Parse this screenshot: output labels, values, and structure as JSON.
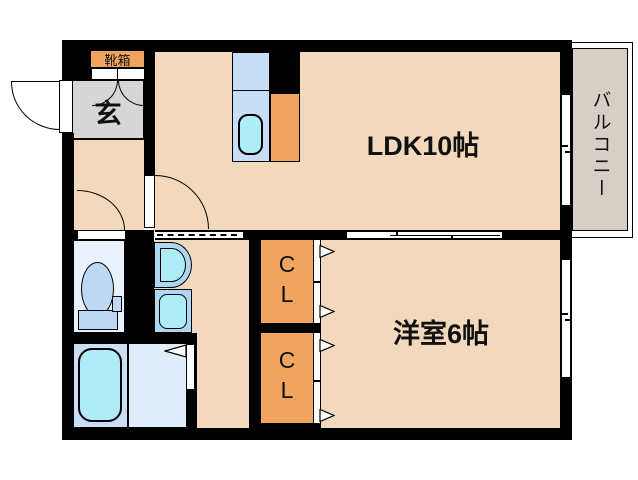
{
  "image_type": "apartment floor plan",
  "rooms": {
    "ldk": {
      "label": "LDK10帖"
    },
    "bedroom": {
      "label": "洋室6帖"
    },
    "balcony": {
      "label": "バルコニー"
    },
    "genkan": {
      "label": "玄"
    },
    "closet1": {
      "label": "C\nL"
    },
    "closet2": {
      "label": "C\nL"
    }
  },
  "fixtures": {
    "shoebox": {
      "label": "靴箱"
    }
  },
  "colors": {
    "floor": "#f2d8bc",
    "wall": "#000000",
    "genkan": "#d6d6d6",
    "balcony": "#d5cfc6",
    "closet": "#f0a45f",
    "counter": "#c7def6",
    "fixture": "#aed7f3",
    "cyan": "#aeedf7",
    "toilet-floor": "#e9f2fc",
    "bath-floor": "#e0edfb",
    "tub-surround": "#cadef6",
    "toilet-fixture": "#bed8f3",
    "ink": "#111111"
  }
}
